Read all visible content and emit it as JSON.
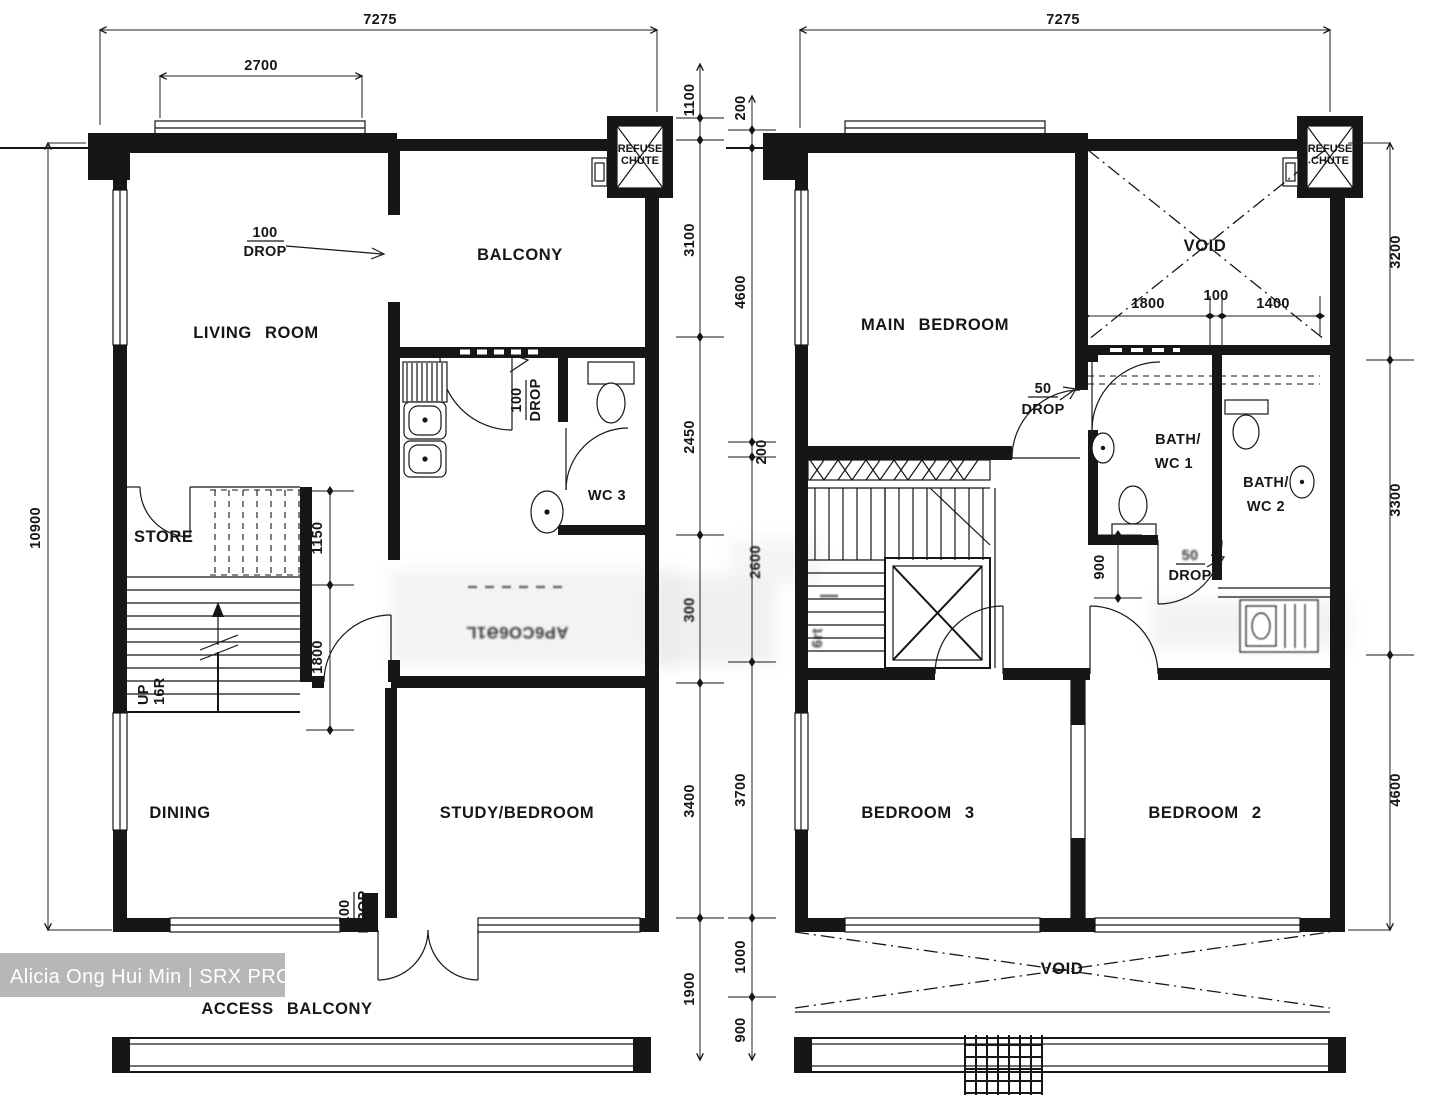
{
  "watermark": {
    "label": "Alicia Ong Hui Min | SRX PROPERTY"
  },
  "lower": {
    "rooms": {
      "living": "LIVING ROOM",
      "balcony": "BALCONY",
      "store": "STORE",
      "dining": "DINING",
      "study": "STUDY/BEDROOM",
      "wc3": "WC 3",
      "access": "ACCESS BALCONY"
    },
    "chute": {
      "l1": "REFUSE",
      "l2": "CHUTE"
    },
    "stairs": {
      "up": "UP",
      "riser": "16R"
    },
    "drops": {
      "balcony": {
        "v": "100",
        "w": "DROP"
      },
      "kitchen": {
        "v": "100",
        "w": "DROP"
      },
      "access": {
        "v": "100",
        "w": "DROP"
      }
    },
    "dims": {
      "width": "7275",
      "window": "2700",
      "height": "10900",
      "right": [
        "1100",
        "3100",
        "2450",
        "300",
        "3400",
        "1900"
      ],
      "stair": [
        "1150",
        "1800"
      ]
    },
    "garbled": "AP6CO6Ə1L"
  },
  "upper": {
    "rooms": {
      "main": "MAIN BEDROOM",
      "b3": "BEDROOM 3",
      "b2": "BEDROOM 2",
      "voidu": "VOID",
      "voidl": "VOID",
      "bath1": [
        "BATH/",
        "WC 1"
      ],
      "bath2": [
        "BATH/",
        "WC 2"
      ]
    },
    "chute": {
      "l1": "REFUSE",
      "l2": "CHUTE"
    },
    "stairs": {
      "garbled": "6rt"
    },
    "drops": {
      "main": {
        "v": "50",
        "w": "DROP"
      },
      "bath": {
        "v": "50",
        "w": "DROP"
      }
    },
    "dims": {
      "width": "7275",
      "left": [
        "200",
        "4600",
        "200",
        "2600",
        "3700",
        "1000",
        "900"
      ],
      "right": [
        "3200",
        "3300",
        "4600"
      ],
      "voidw": [
        "1800",
        "100",
        "1400"
      ],
      "bath": "900"
    }
  }
}
